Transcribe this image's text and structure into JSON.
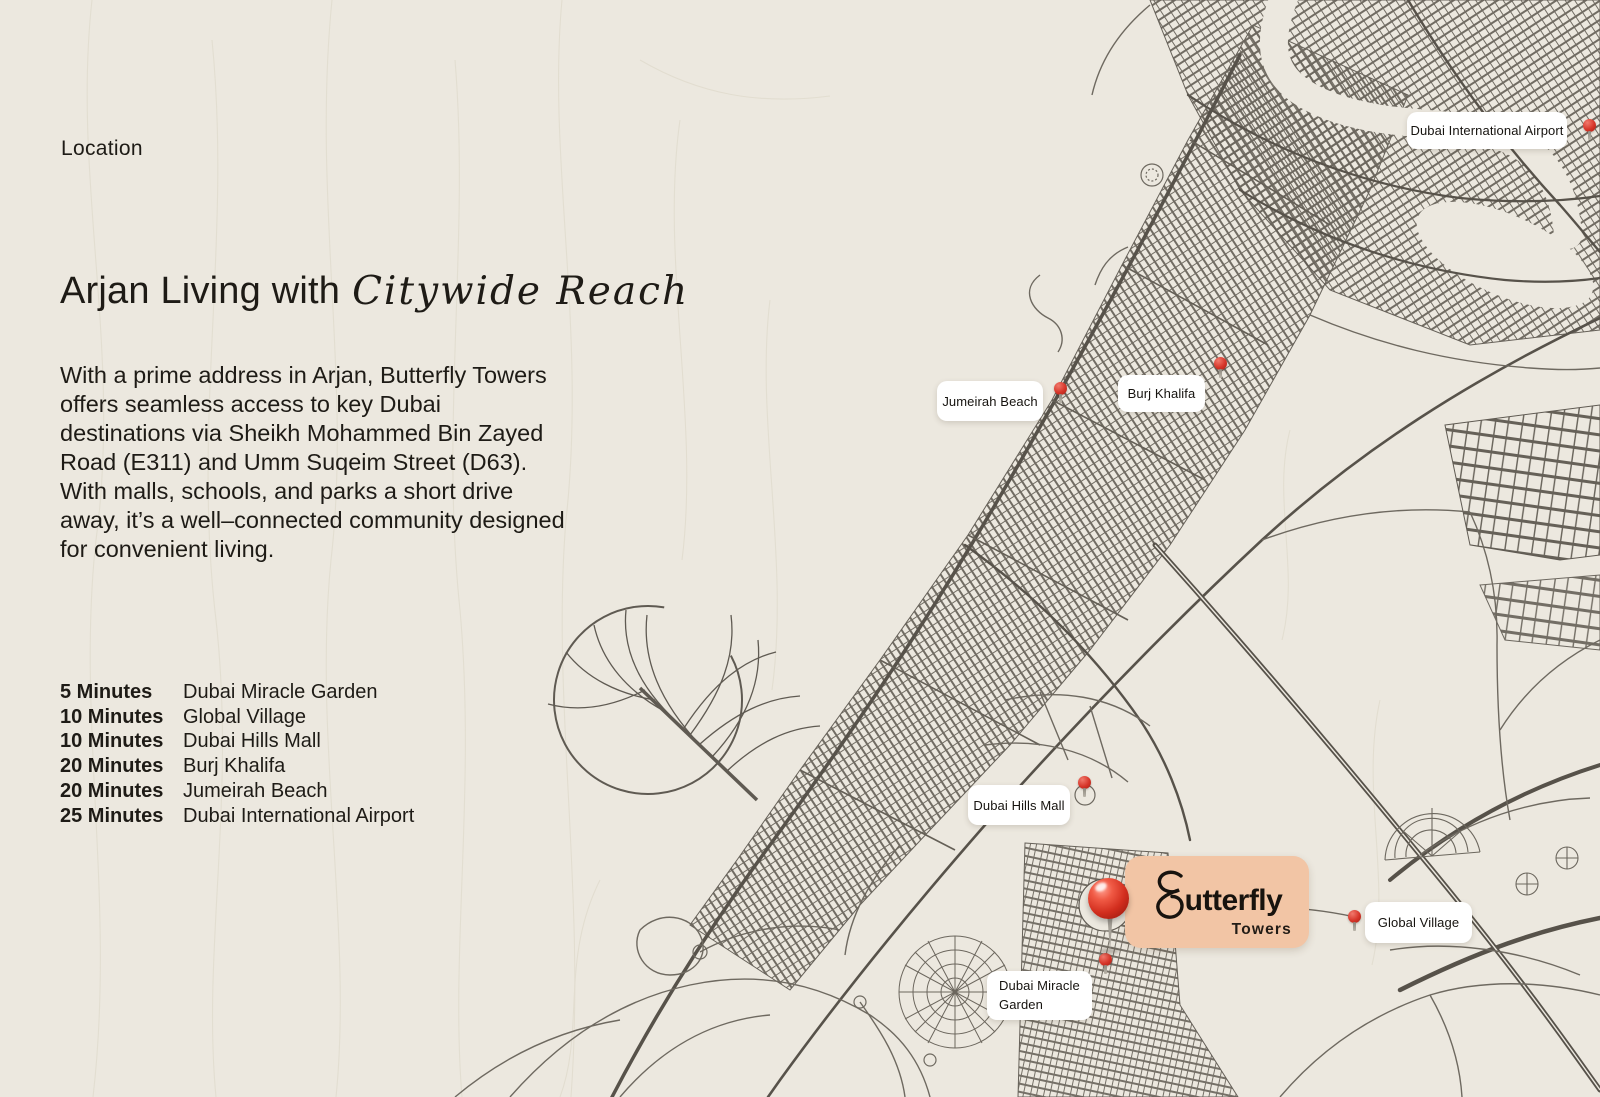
{
  "page": {
    "location_label": "Location",
    "background_color": "#ece8df"
  },
  "intro": {
    "heading_regular": "Arjan Living with",
    "heading_script": "Citywide Reach",
    "paragraph": "With a prime address in Arjan, Butterfly Towers offers seamless access to key Dubai destinations via Sheikh Mohammed Bin Zayed Road (E311) and Umm Suqeim Street (D63). With malls, schools, and parks a short drive away, it’s a well–connected community designed for convenient living."
  },
  "travel_times": [
    {
      "time": "5 Minutes",
      "destination": "Dubai Miracle Garden"
    },
    {
      "time": "10 Minutes",
      "destination": "Global Village"
    },
    {
      "time": "10 Minutes",
      "destination": "Dubai Hills Mall"
    },
    {
      "time": "20 Minutes",
      "destination": "Burj Khalifa"
    },
    {
      "time": "20 Minutes",
      "destination": "Jumeirah Beach"
    },
    {
      "time": "25 Minutes",
      "destination": "Dubai International Airport"
    }
  ],
  "map": {
    "labels": [
      {
        "text": "Dubai International Airport"
      },
      {
        "text": "Jumeirah Beach"
      },
      {
        "text": "Burj Khalifa"
      },
      {
        "text": "Dubai Hills Mall"
      },
      {
        "text": "Global Village"
      },
      {
        "text": "Dubai Miracle Garden"
      }
    ],
    "badge": {
      "brand_initial": "B",
      "brand_rest": "utterfly",
      "sub": "Towers",
      "badge_color": "#f2c5a5"
    },
    "pin_color": "#d63529",
    "road_color": "#5f5a52",
    "background_color": "#ece8df"
  }
}
